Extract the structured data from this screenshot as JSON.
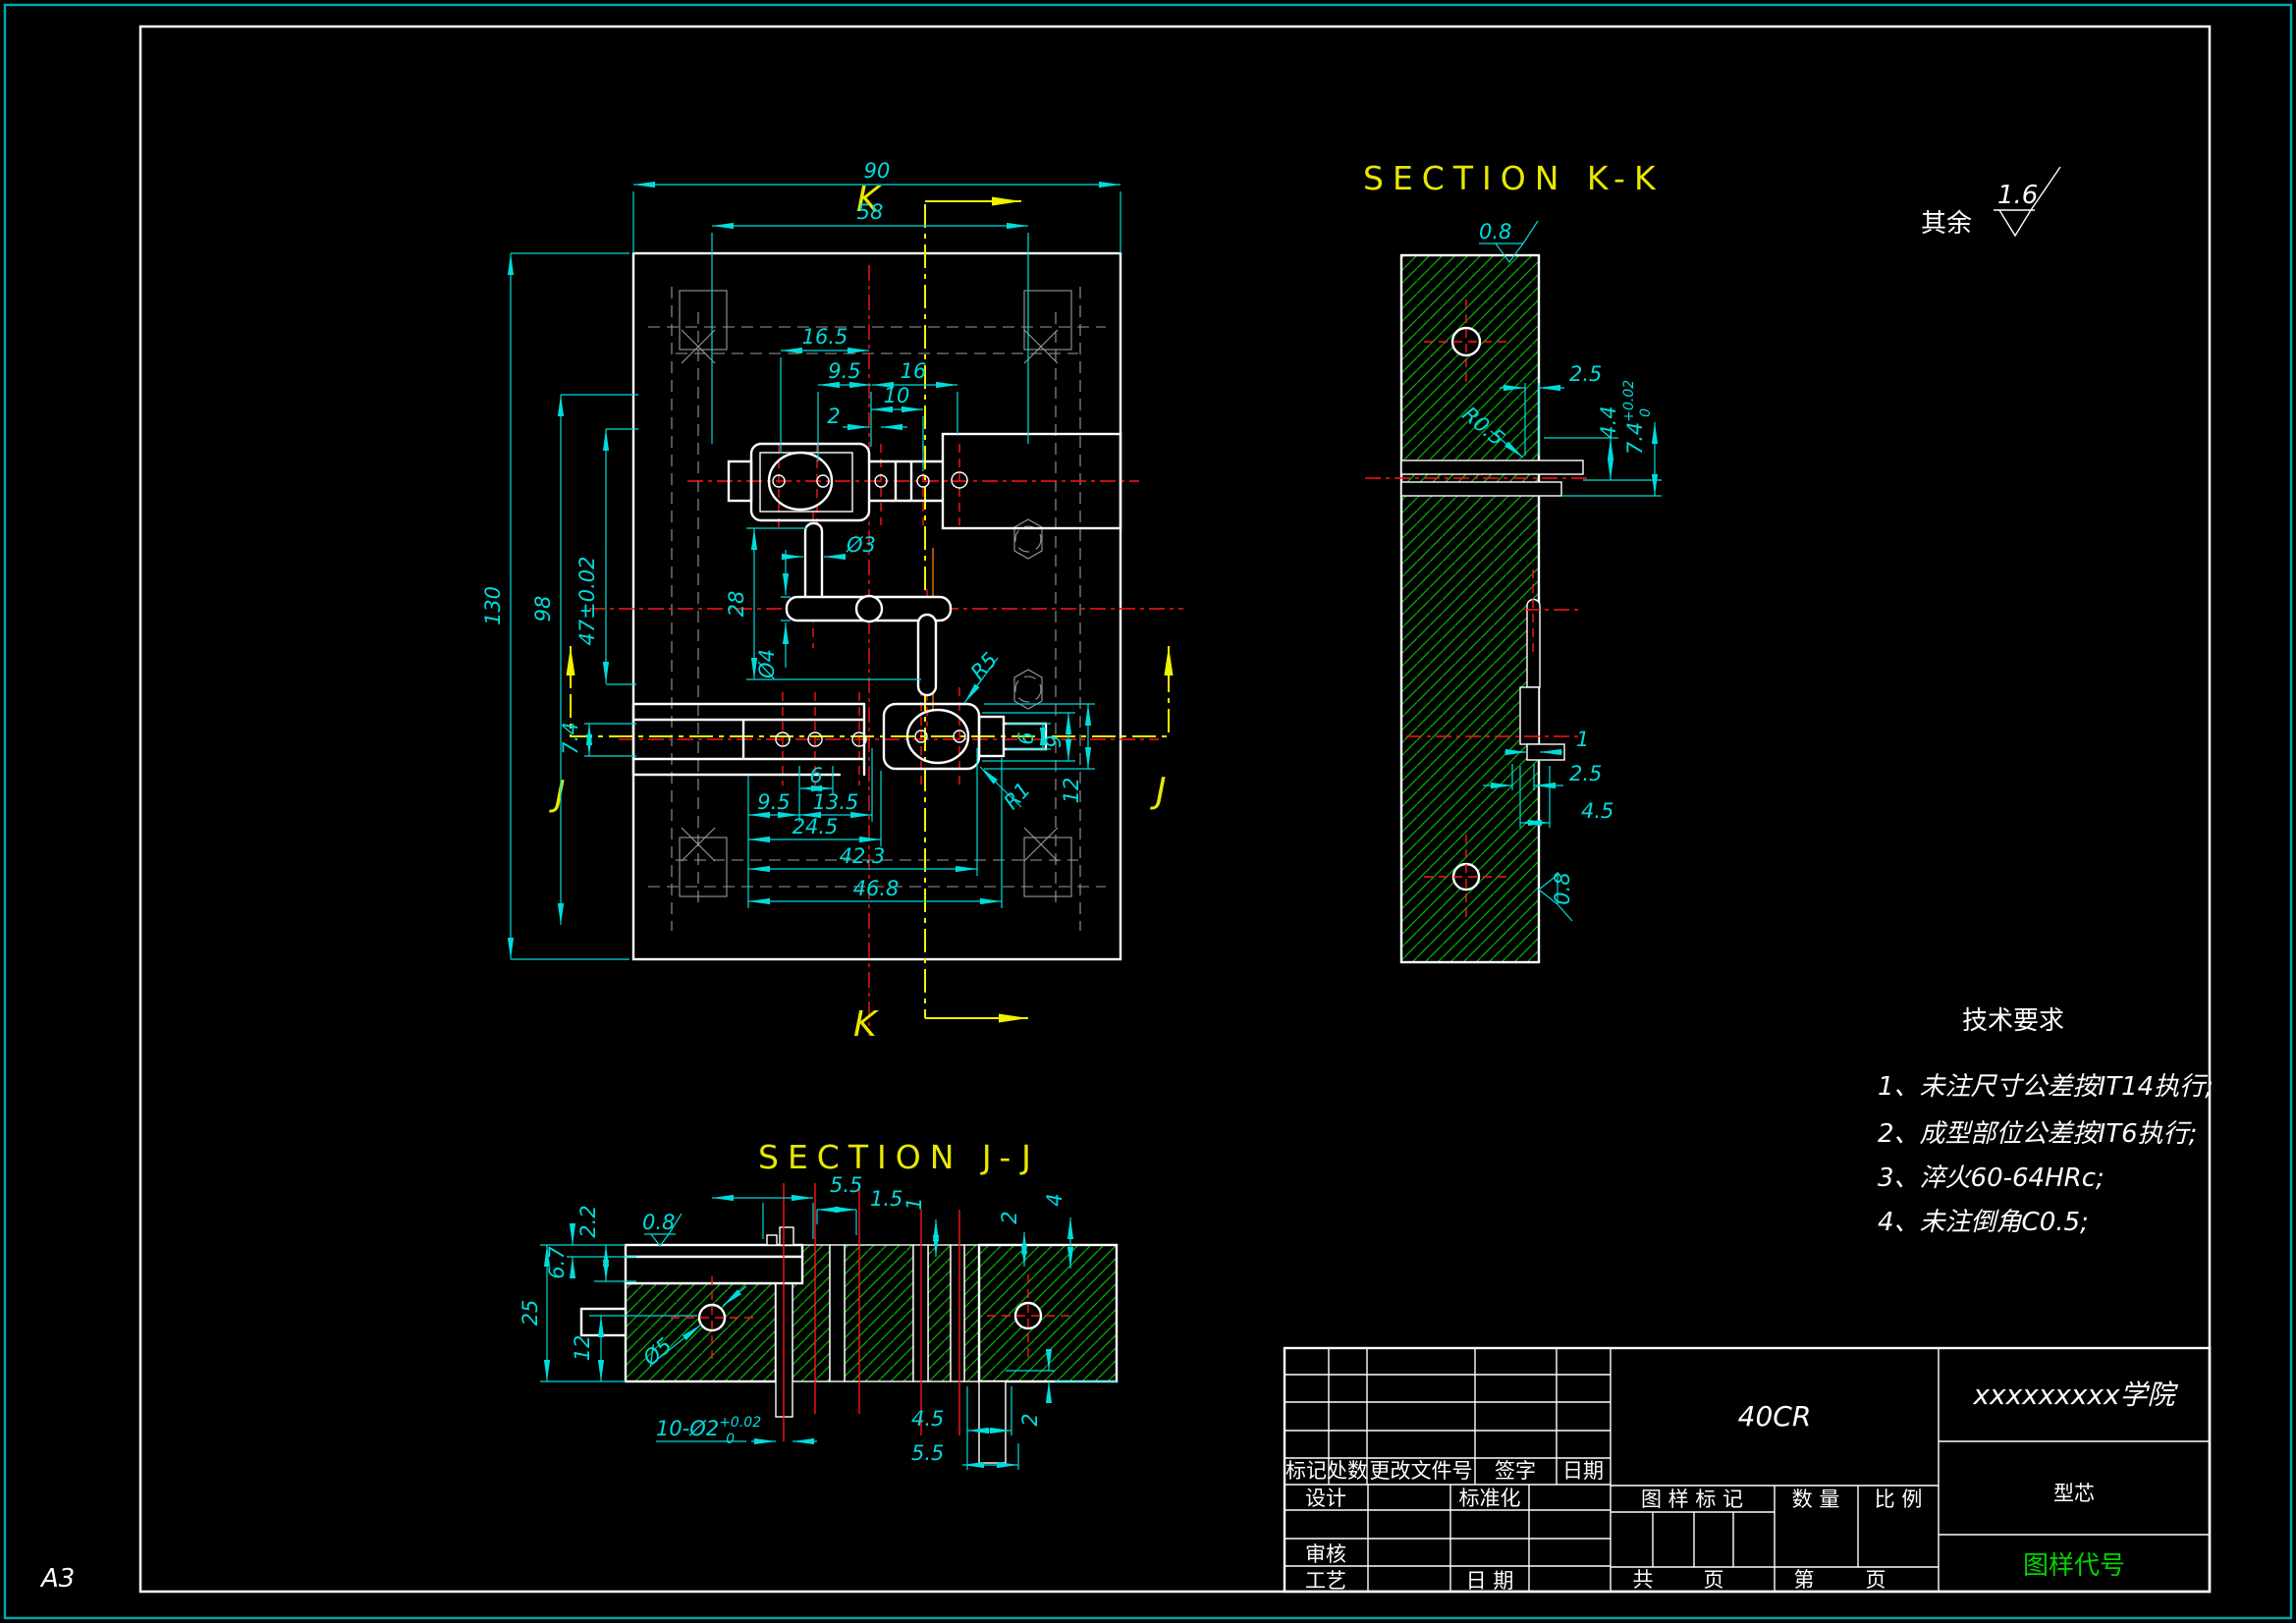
{
  "colors": {
    "background": "#000000",
    "dimension_cyan": "#00dcdc",
    "centerline_red": "#ff1515",
    "hatch_green": "#00b400",
    "section_yellow": "#f2f200",
    "outline_white": "#ffffff",
    "hidden_gray": "#9a9a9a",
    "code_green": "#00d400",
    "border_teal": "#00a8a8"
  },
  "sheet": {
    "format": "A3"
  },
  "general_roughness": {
    "prefix": "其余",
    "value": "1.6"
  },
  "tech": {
    "title": "技术要求",
    "items": [
      "1、未注尺寸公差按IT14执行;",
      "2、成型部位公差按IT6执行;",
      "3、淬火60-64HRc;",
      "4、未注倒角C0.5;"
    ]
  },
  "main": {
    "t90": "90",
    "t58": "58",
    "t165": "16.5",
    "t95": "9.5",
    "t16": "16",
    "t10": "10",
    "t2": "2",
    "l130": "130",
    "l98": "98",
    "l47": "47±0.02",
    "l74": "7.4",
    "c28": "28",
    "d4": "Ø4",
    "d3": "Ø3",
    "r5": "R5",
    "r1": "R1",
    "r6": "6",
    "r9": "9",
    "r12": "12",
    "b6": "6",
    "b95": "9.5",
    "b135": "13.5",
    "b245": "24.5",
    "b423": "42.3",
    "b468": "46.8"
  },
  "kk": {
    "title": "SECTION K-K",
    "marker": "K",
    "rough_top": "0.8",
    "w25": "2.5",
    "r05": "R0.5",
    "h44": "4.4",
    "h74": "7.4",
    "h74sup": "+0.02",
    "h74sub": "0",
    "w1": "1",
    "w25b": "2.5",
    "w45": "4.5",
    "rough_side": "0.8"
  },
  "jj": {
    "title": "SECTION J-J",
    "marker": "J",
    "rough": "0.8",
    "t55": "5.5",
    "t15": "1.5",
    "t1": "1",
    "t2": "2",
    "t4": "4",
    "l22": "2.2",
    "l67": "6.7",
    "l25": "25",
    "l12": "12",
    "dia5": "Ø5",
    "pins": "10-Ø2",
    "pins_sup": "+0.02",
    "pins_sub": "0",
    "b45": "4.5",
    "b55": "5.5",
    "b2": "2"
  },
  "title_block": {
    "material": "40CR",
    "school": "xxxxxxxxx学院",
    "part": "型芯",
    "code": "图样代号",
    "mark": "标记",
    "count": "处数",
    "change": "更改文件号",
    "sign": "签字",
    "date": "日期",
    "design": "设计",
    "standard": "标准化",
    "audit": "审核",
    "process": "工艺",
    "date2": "日 期",
    "stamp": "图 样 标 记",
    "quantity": "数 量",
    "scale": "比 例",
    "total": "共",
    "pages": "页",
    "no": "第",
    "pages2": "页"
  }
}
